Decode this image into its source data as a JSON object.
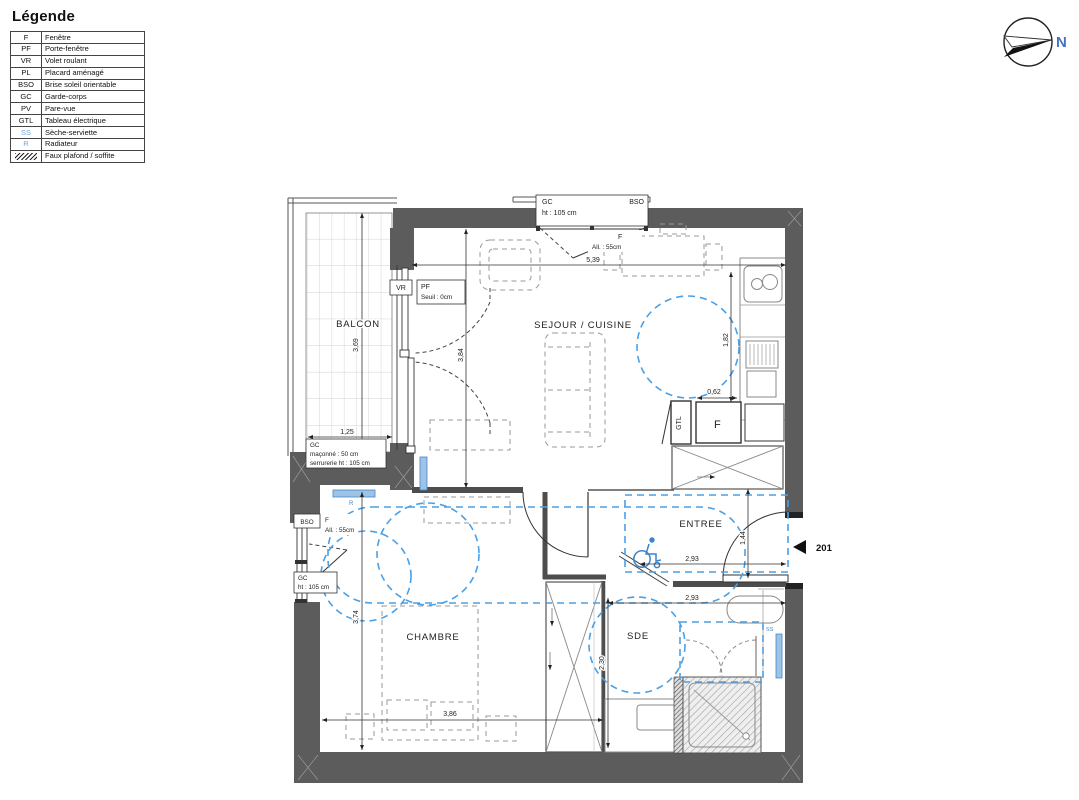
{
  "legend": {
    "title": "Légende",
    "items": [
      {
        "abbr": "F",
        "label": "Fenêtre"
      },
      {
        "abbr": "PF",
        "label": "Porte-fenêtre"
      },
      {
        "abbr": "VR",
        "label": "Volet roulant"
      },
      {
        "abbr": "PL",
        "label": "Placard aménagé"
      },
      {
        "abbr": "BSO",
        "label": "Brise soleil orientable"
      },
      {
        "abbr": "GC",
        "label": "Garde-corps"
      },
      {
        "abbr": "PV",
        "label": "Pare-vue"
      },
      {
        "abbr": "GTL",
        "label": "Tableau électrique"
      },
      {
        "abbr": "SS",
        "label": "Sèche-serviette"
      },
      {
        "abbr": "R",
        "label": "Radiateur"
      },
      {
        "abbr": "",
        "label": "Faux plafond / soffite",
        "swatch": "diagonal-hatch"
      }
    ]
  },
  "compass": {
    "label": "N"
  },
  "plan": {
    "unit_number": "201",
    "rooms": {
      "balcon": "BALCON",
      "sejour": "SEJOUR / CUISINE",
      "entree": "ENTREE",
      "chambre": "CHAMBRE",
      "sde": "SDE"
    },
    "ann": {
      "gc": "GC",
      "gc_ht": "ht : 105 cm",
      "bso": "BSO",
      "f": "F",
      "all": "All. : 55cm",
      "vr": "VR",
      "pf": "PF",
      "seuil": "Seuil : 0cm",
      "gc_balcon_1": "GC",
      "gc_balcon_2": "maçonné : 50 cm",
      "gc_balcon_3": "serrurerie ht : 105 cm",
      "gtl": "GTL",
      "r": "R",
      "ss": "SS"
    },
    "dims": {
      "a": "5,39",
      "b": "3,69",
      "c": "1,25",
      "d": "3,84",
      "e": "1,82",
      "f": "0,62",
      "g": "3,74",
      "h": "3,86",
      "i": "2,30",
      "j": "2,93",
      "k": "2,93",
      "l": "1,44"
    },
    "colors": {
      "wall": "#5c5c5c",
      "accessibility_blue": "#4aa0e6",
      "radiator_fill": "#9dc3e6",
      "legend_blue": "#6fa3d8",
      "north_blue": "#4472c4"
    }
  }
}
